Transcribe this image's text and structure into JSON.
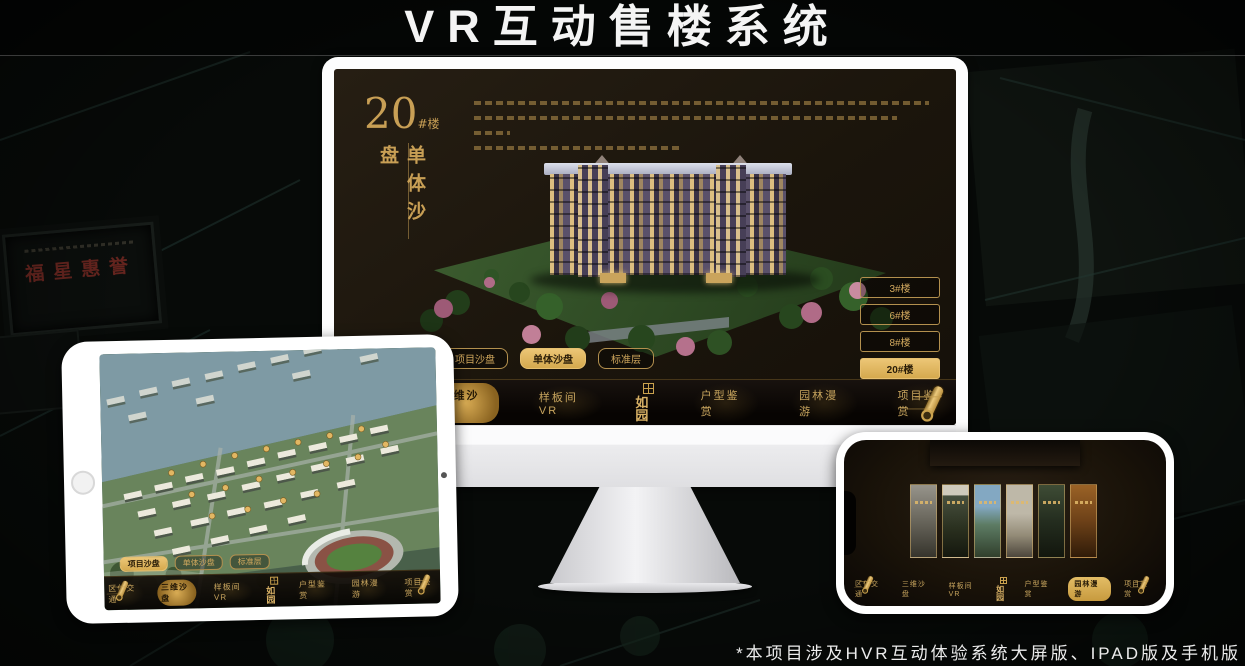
{
  "page": {
    "title": "VR互动售楼系统",
    "footnote": "*本项目涉及HVR互动体验系统大屏版、IPAD版及手机版"
  },
  "colors": {
    "gold": "#d2a95e",
    "gold_active_bg": "#ddb259",
    "gold_active_text": "#2a1d08"
  },
  "background": {
    "plaque_title": "福星惠誉"
  },
  "desktop": {
    "heading": {
      "number": "20",
      "suffix": "#楼",
      "subtitle": "单体沙盘"
    },
    "floor_buttons": [
      {
        "label": "3#楼",
        "active": false
      },
      {
        "label": "6#楼",
        "active": false
      },
      {
        "label": "8#楼",
        "active": false
      },
      {
        "label": "20#楼",
        "active": true
      }
    ],
    "sub_tabs": [
      {
        "label": "项目沙盘",
        "active": false
      },
      {
        "label": "单体沙盘",
        "active": true
      },
      {
        "label": "标准层",
        "active": false
      }
    ],
    "nav_items": [
      {
        "label": "区位交通",
        "active": false
      },
      {
        "label": "三维沙盘",
        "active": true
      },
      {
        "label": "样板间VR",
        "active": false
      },
      {
        "label": "户型鉴赏",
        "active": false
      },
      {
        "label": "园林漫游",
        "active": false
      },
      {
        "label": "项目鉴赏",
        "active": false
      }
    ],
    "logo": "如园"
  },
  "ipad": {
    "sub_tabs": [
      {
        "label": "项目沙盘",
        "active": true
      },
      {
        "label": "单体沙盘",
        "active": false
      },
      {
        "label": "标准层",
        "active": false
      }
    ],
    "nav_items": [
      {
        "label": "区位交通",
        "active": false
      },
      {
        "label": "三维沙盘",
        "active": true
      },
      {
        "label": "样板间VR",
        "active": false
      },
      {
        "label": "户型鉴赏",
        "active": false
      },
      {
        "label": "园林漫游",
        "active": false
      },
      {
        "label": "项目鉴赏",
        "active": false
      }
    ],
    "logo": "如园"
  },
  "phone": {
    "nav_items": [
      {
        "label": "区位交通",
        "active": false
      },
      {
        "label": "三维沙盘",
        "active": false
      },
      {
        "label": "样板间VR",
        "active": false
      },
      {
        "label": "户型鉴赏",
        "active": false
      },
      {
        "label": "园林漫游",
        "active": true
      },
      {
        "label": "项目鉴赏",
        "active": false
      }
    ],
    "logo": "如园"
  }
}
